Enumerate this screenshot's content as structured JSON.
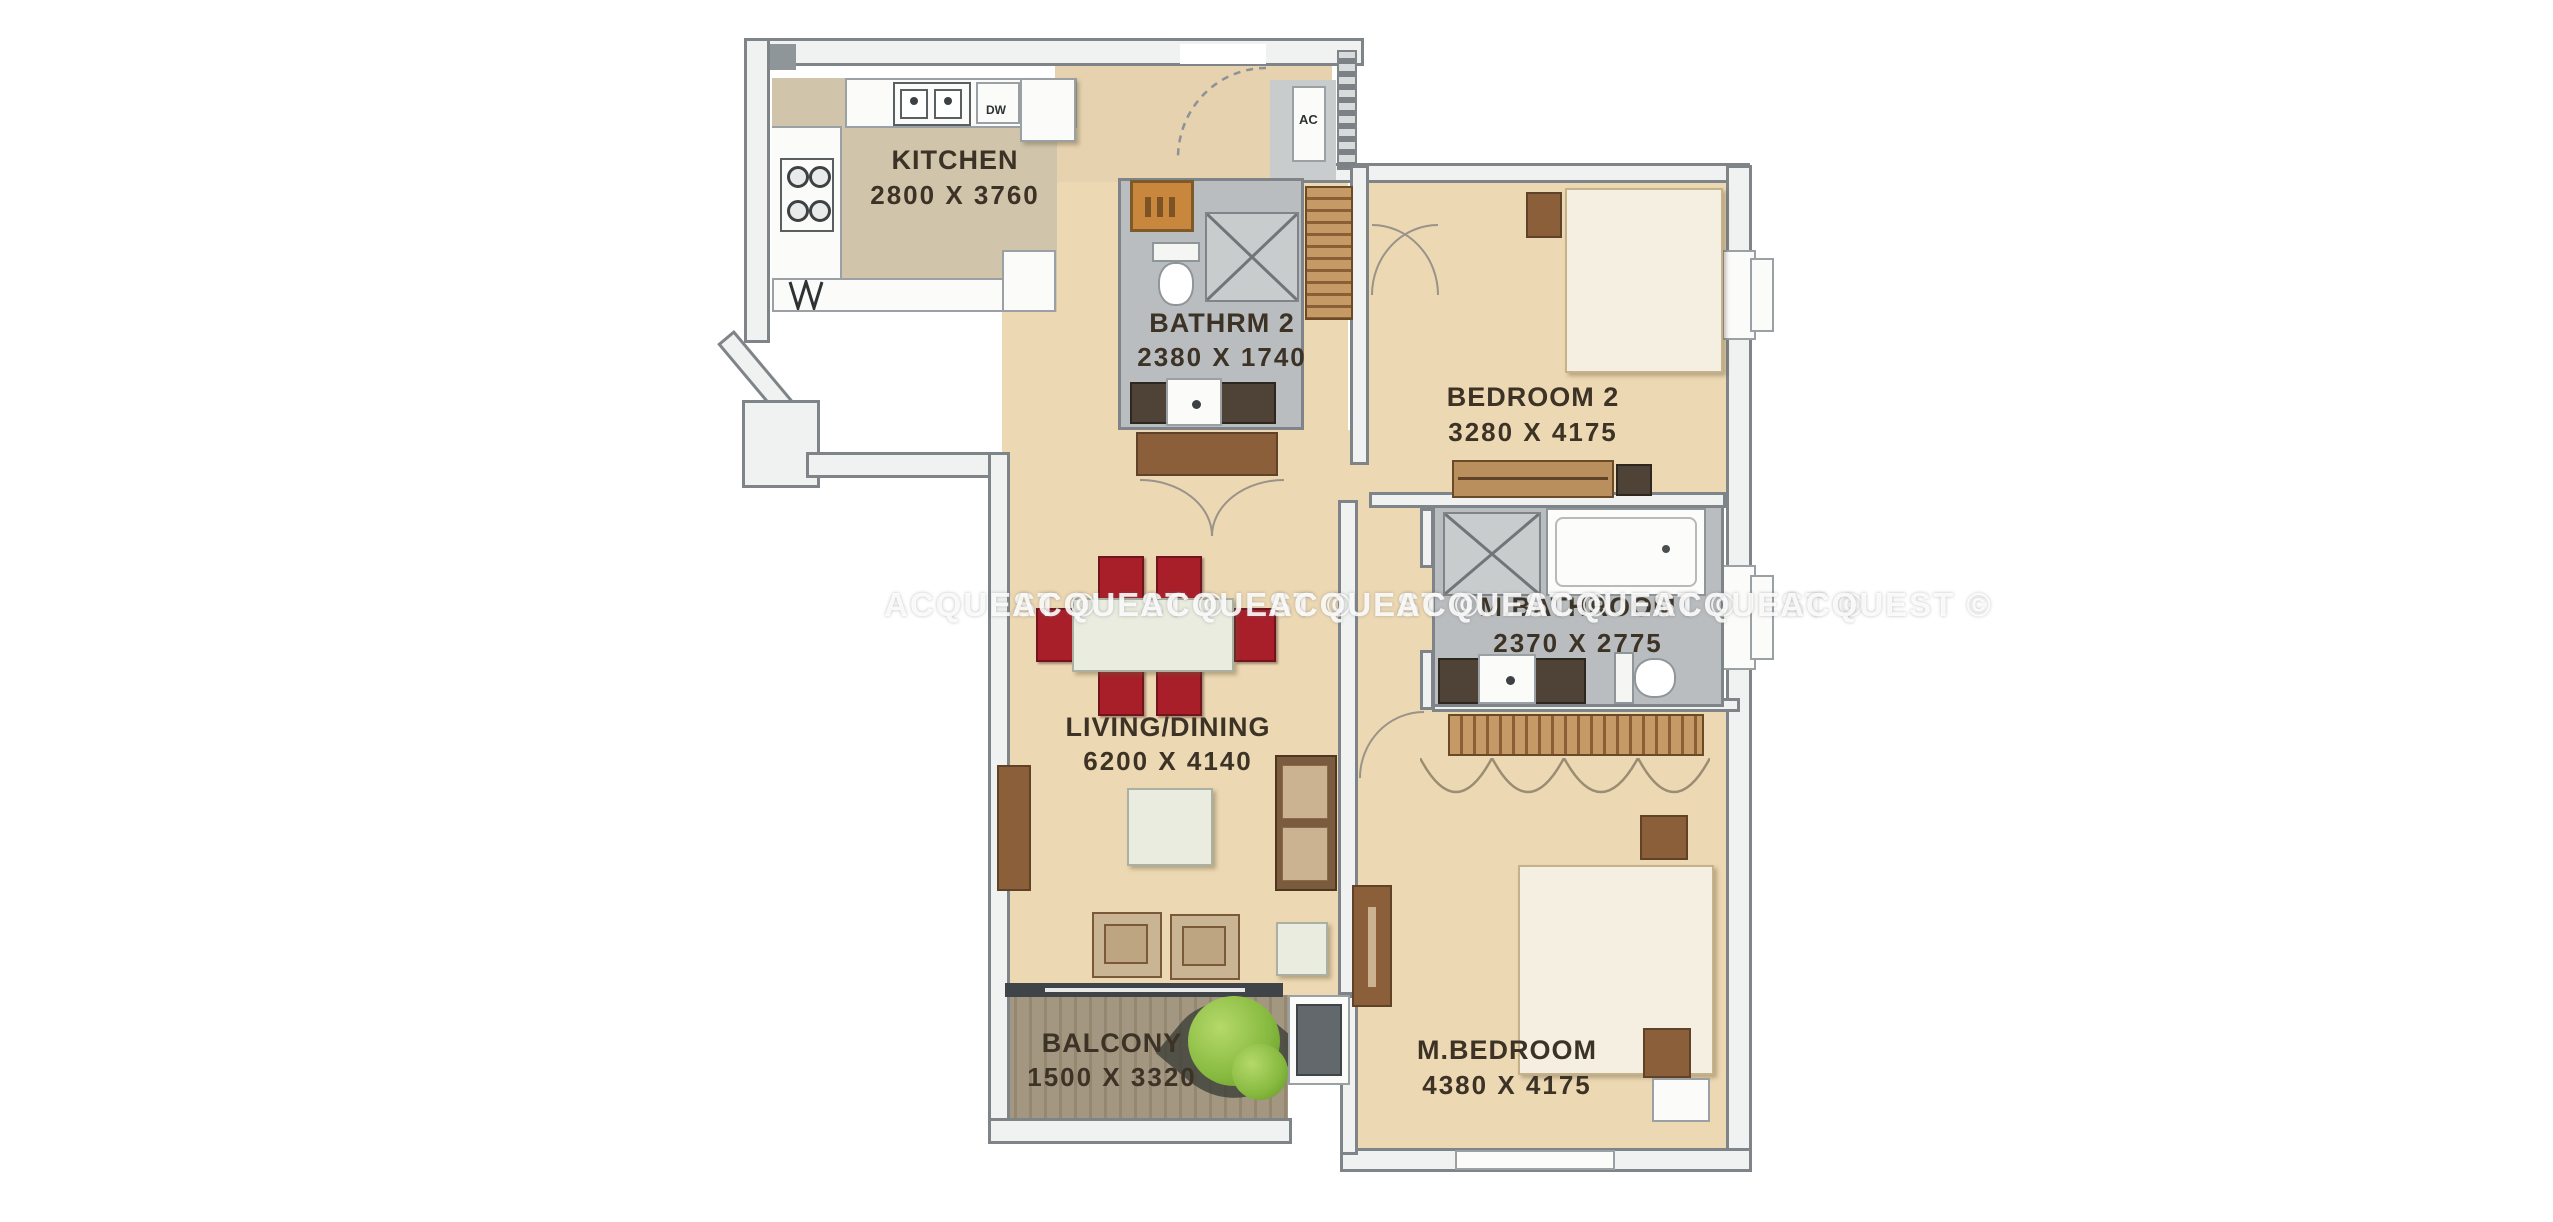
{
  "watermark": {
    "text": "ACQUEST ©",
    "repeat": 8
  },
  "rooms": {
    "kitchen": {
      "name": "KITCHEN",
      "dims": "2800 X 3760"
    },
    "bathrm2": {
      "name": "BATHRM 2",
      "dims": "2380 X 1740"
    },
    "bedroom2": {
      "name": "BEDROOM 2",
      "dims": "3280 X 4175"
    },
    "mbathroom": {
      "name": "M.BATHROOM",
      "dims": "2370 X 2775"
    },
    "living": {
      "name": "LIVING/DINING",
      "dims": "6200 X 4140"
    },
    "balcony": {
      "name": "BALCONY",
      "dims": "1500 X 3320"
    },
    "mbedroom": {
      "name": "M.BEDROOM",
      "dims": "4380 X 4175"
    }
  },
  "labels": {
    "ac": "AC",
    "dw": "DW"
  },
  "colors": {
    "wall": "#8f969a",
    "floor_beige": "#ecd8b2",
    "floor_kitchen": "#d0c5ab",
    "floor_bath": "#babdbf",
    "floor_balcony": "#a39781",
    "chair_red": "#a81f2a",
    "wood_brown": "#8a5f3a",
    "plant_green": "#86b93f",
    "water_heater_orange": "#c9873e",
    "watermark_white": "#ffffff",
    "label_text": "#3c3326"
  }
}
